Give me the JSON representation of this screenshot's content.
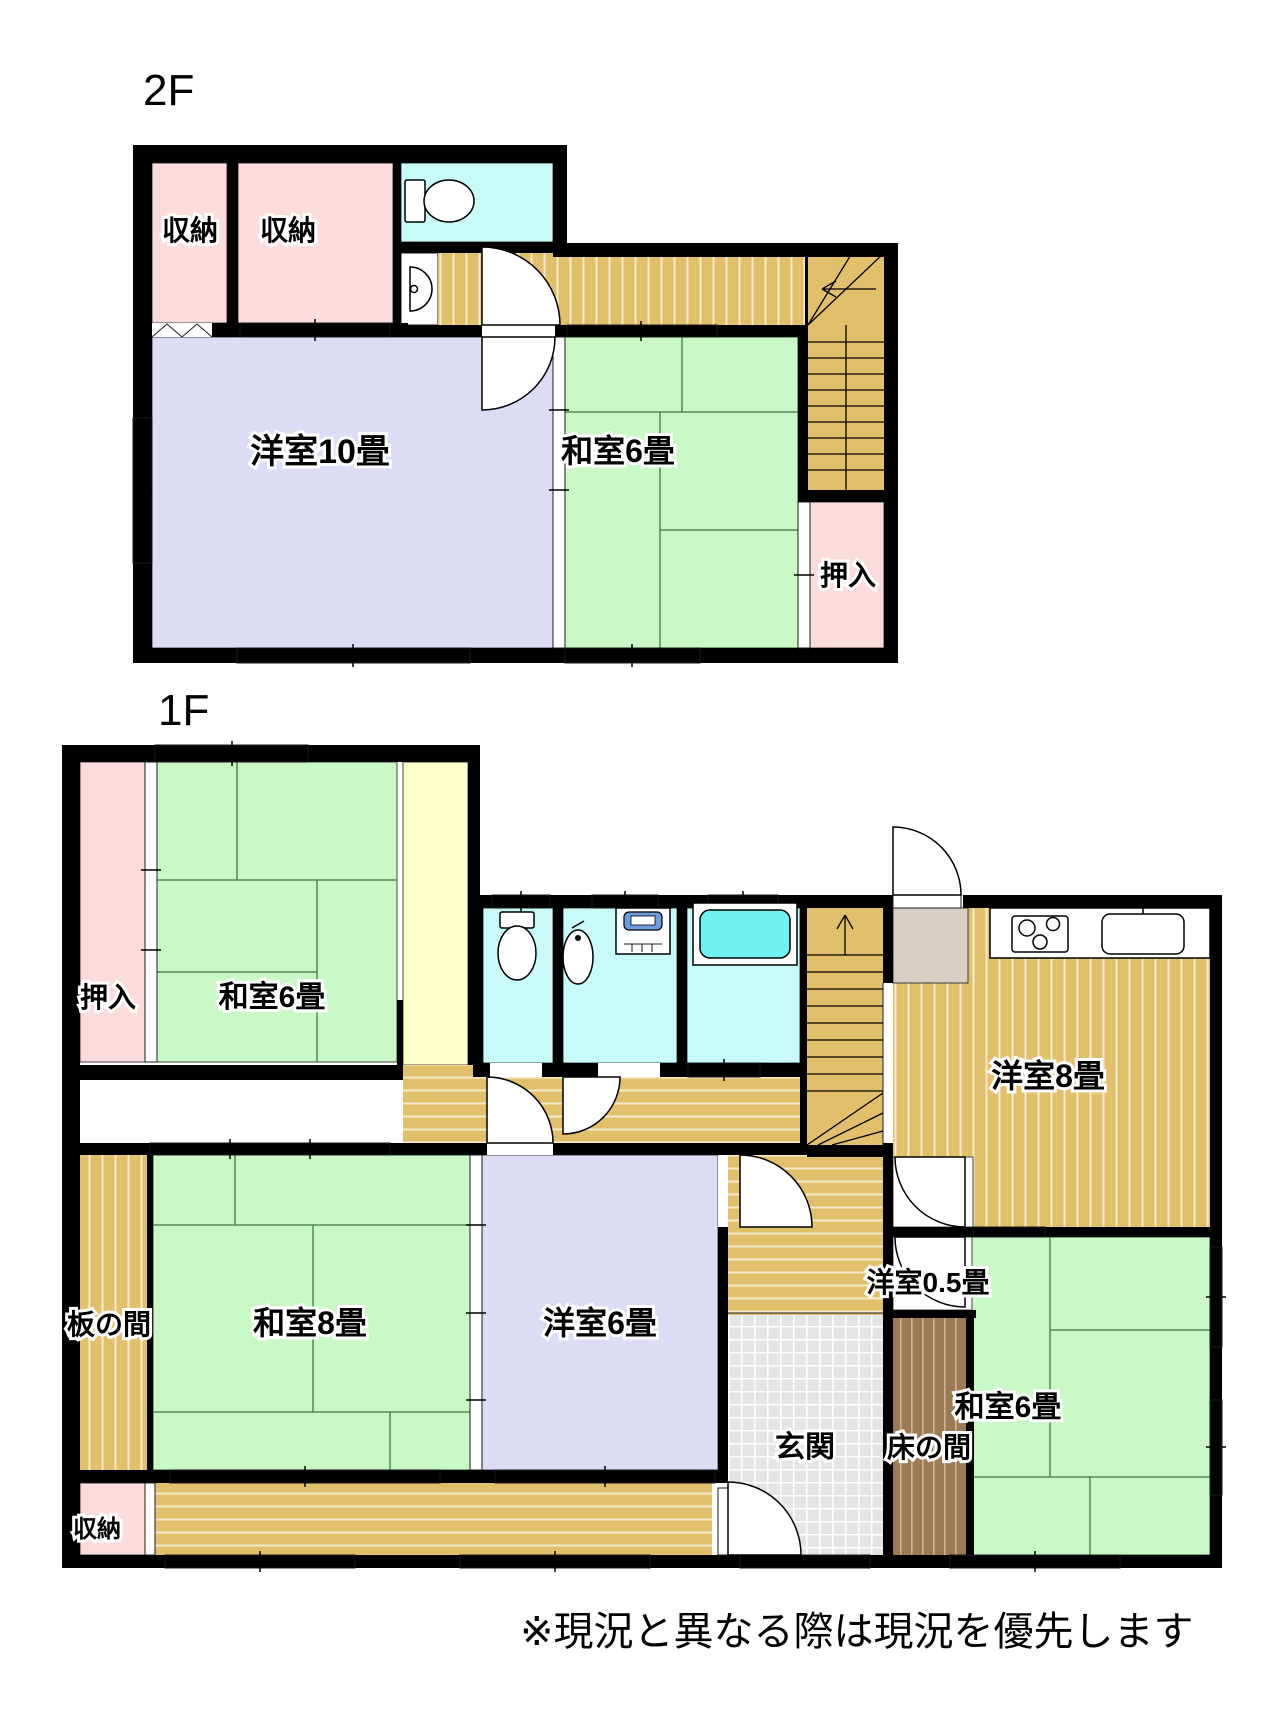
{
  "floors": [
    {
      "name": "2F",
      "label": "2F",
      "rooms": [
        {
          "key": "closet-a",
          "label": "収納"
        },
        {
          "key": "closet-b",
          "label": "収納"
        },
        {
          "key": "western-room-10",
          "label": "洋室10畳"
        },
        {
          "key": "japanese-room-6",
          "label": "和室6畳"
        },
        {
          "key": "oshiire-closet",
          "label": "押入"
        }
      ],
      "fixtures": [
        "toilet-icon",
        "hand-sink-icon",
        "staircase-down"
      ]
    },
    {
      "name": "1F",
      "label": "1F",
      "rooms": [
        {
          "key": "oshiire-closet",
          "label": "押入"
        },
        {
          "key": "japanese-room-6-nw",
          "label": "和室6畳"
        },
        {
          "key": "western-room-8-kitchen",
          "label": "洋室8畳"
        },
        {
          "key": "western-room-0-5",
          "label": "洋室0.5畳"
        },
        {
          "key": "itanoma-wood-floor",
          "label": "板の間"
        },
        {
          "key": "japanese-room-8",
          "label": "和室8畳"
        },
        {
          "key": "western-room-6",
          "label": "洋室6畳"
        },
        {
          "key": "genkan-entrance",
          "label": "玄関"
        },
        {
          "key": "tokonoma-alcove",
          "label": "床の間"
        },
        {
          "key": "japanese-room-6-se",
          "label": "和室6畳"
        },
        {
          "key": "storage-closet",
          "label": "収納"
        }
      ],
      "fixtures": [
        "toilet-icon",
        "wash-basin-icon",
        "washing-machine-icon",
        "bathtub-icon",
        "gas-stove-icon",
        "kitchen-sink-icon",
        "staircase-up"
      ]
    }
  ],
  "footer_note": "※現況と異なる際は現況を優先します",
  "colors": {
    "tatami_green": "#C9F7C5",
    "wood_tan": "#E2BF6B",
    "wood_stripe": "#F5EBCE",
    "closet_pink": "#FBDBDB",
    "western_lavender": "#DCDCF5",
    "water_cyan": "#C7FAF8",
    "bathtub_cyan": "#70F2F2",
    "corridor_yellow": "#FFFFC9",
    "tile_gray": "#E4E4E4",
    "tokonoma_brown": "#9C7A55",
    "pantry_gray": "#D7CFC5",
    "washer_blue": "#6C9BE0",
    "wall_black": "#000000"
  }
}
